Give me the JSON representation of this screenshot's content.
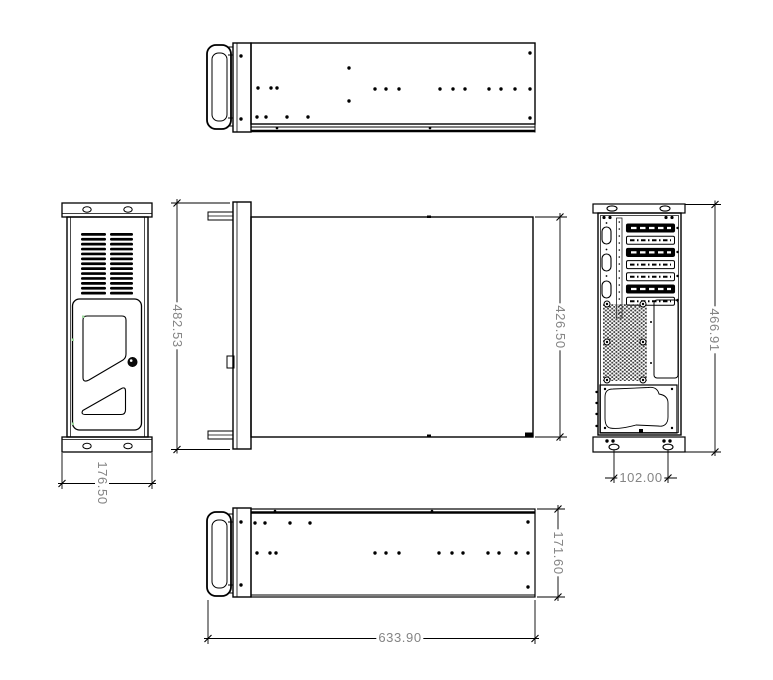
{
  "colors": {
    "background": "#ffffff",
    "line": "#000000",
    "dimension_text": "#848484",
    "mesh": "#3f3f3f",
    "snap_marker": "#9fd89f"
  },
  "dimensions": {
    "plan_overall_width": "482.53",
    "plan_body_width": "426.50",
    "front_panel_height": "176.50",
    "rear_overall_height": "466.91",
    "rear_foot_spacing": "102.00",
    "side_panel_height": "171.60",
    "side_panel_length": "633.90"
  }
}
